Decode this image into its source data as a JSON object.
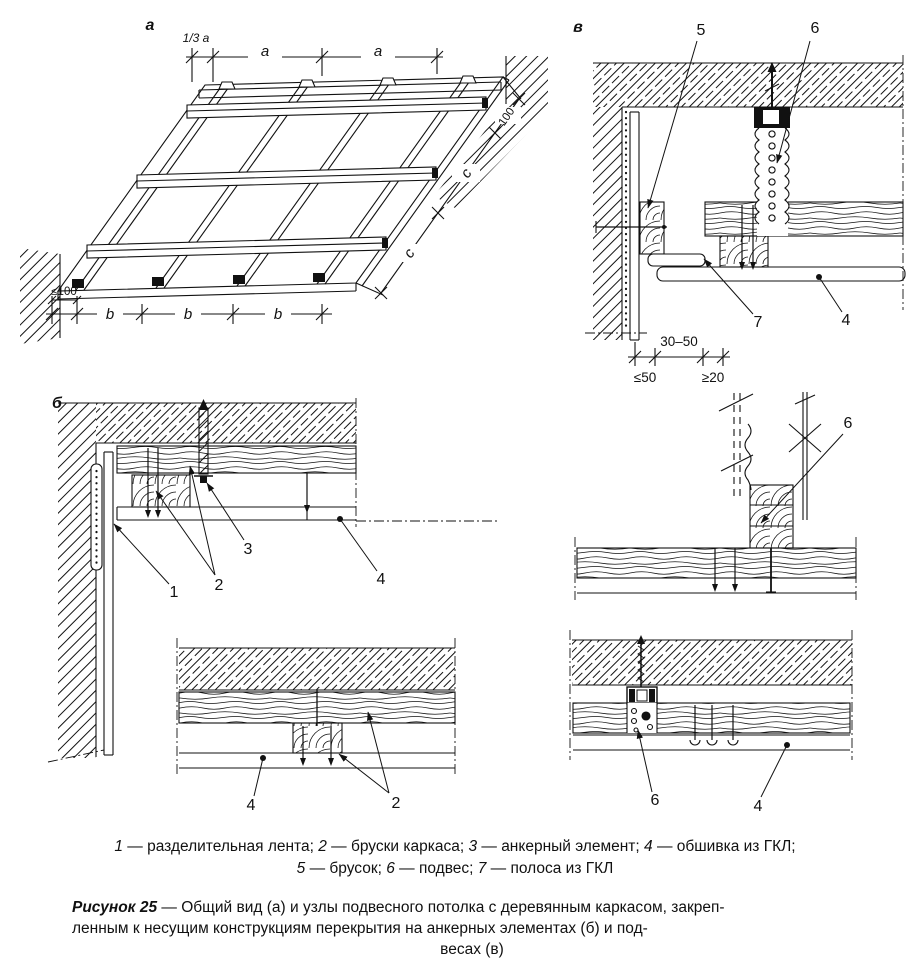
{
  "figure": {
    "panel_a_label": "а",
    "panel_b_label": "б",
    "panel_v_label": "в",
    "dims_a": {
      "third_a": "1/3 а",
      "a1": "а",
      "a2": "а",
      "b1": "b",
      "b2": "b",
      "b3": "b",
      "le100": "≤100",
      "c1": "с",
      "c2": "с",
      "n100": "100"
    },
    "dims_v": {
      "range": "30–50",
      "le50": "≤50",
      "ge20": "≥20"
    },
    "callouts_v_top": {
      "c5": "5",
      "c6": "6",
      "c7": "7",
      "c4": "4"
    },
    "callouts_b_top": {
      "c1": "1",
      "c2": "2",
      "c3": "3",
      "c4": "4"
    },
    "callouts_b_bottom": {
      "c4": "4",
      "c2": "2"
    },
    "callouts_v_mid": {
      "c6": "6"
    },
    "callouts_v_bottom": {
      "c6": "6",
      "c4": "4"
    }
  },
  "legend": {
    "items": [
      {
        "n": "1",
        "t": "разделительная лента"
      },
      {
        "n": "2",
        "t": "бруски каркаса"
      },
      {
        "n": "3",
        "t": "анкерный элемент"
      },
      {
        "n": "4",
        "t": "обшивка из ГКЛ"
      },
      {
        "n": "5",
        "t": "брусок"
      },
      {
        "n": "6",
        "t": "подвес"
      },
      {
        "n": "7",
        "t": "полоса из ГКЛ"
      }
    ]
  },
  "caption": {
    "label": "Рисунок 25",
    "dash": "—",
    "line1_rest": "Общий вид (а) и узлы подвесного потолка с деревянным каркасом, закреп-",
    "line2": "ленным к несущим конструкциям перекрытия на анкерных элементах (б) и под-",
    "line3": "весах (в)"
  }
}
